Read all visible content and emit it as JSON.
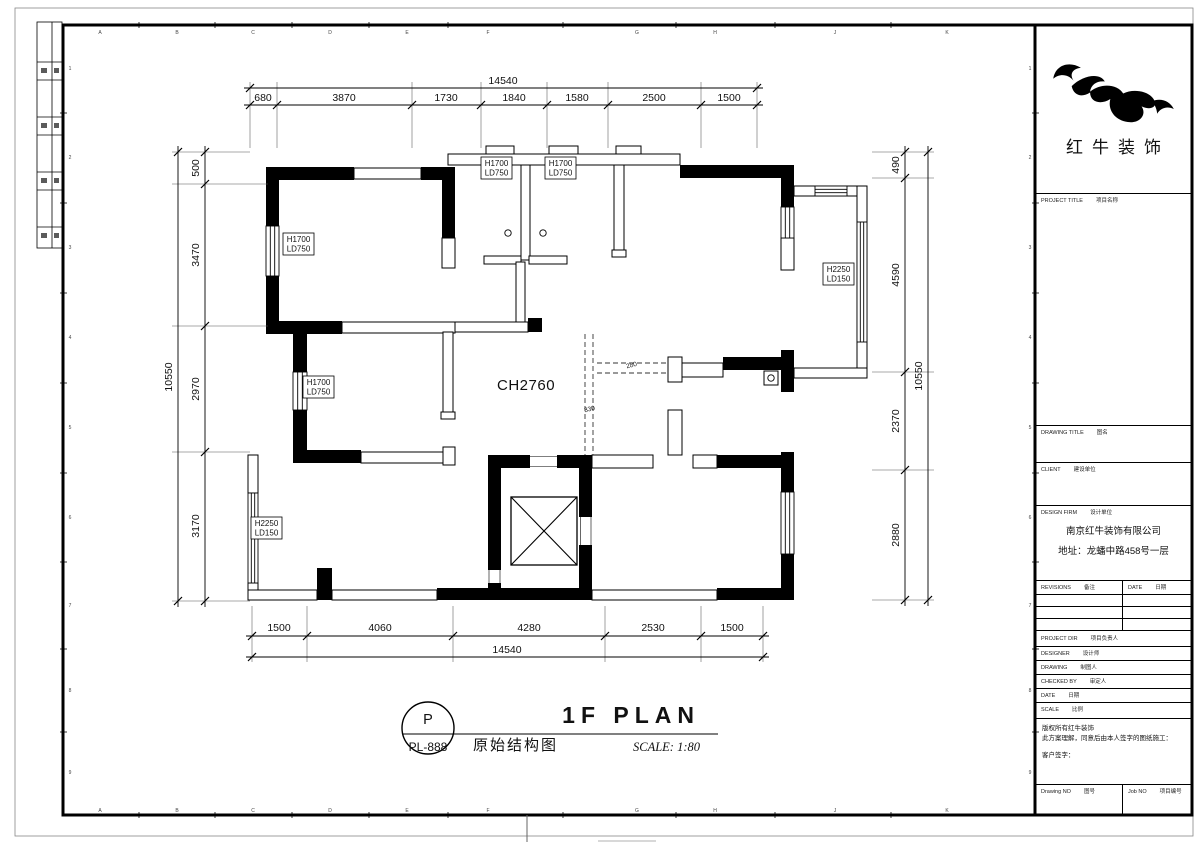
{
  "sheet": {
    "grid_letters": [
      "A",
      "B",
      "C",
      "D",
      "E",
      "F",
      "G",
      "H",
      "J",
      "K"
    ],
    "grid_numbers": [
      "1",
      "2",
      "3",
      "4",
      "5",
      "6",
      "7",
      "8",
      "9"
    ]
  },
  "plan": {
    "ch_label": "CH2760",
    "beam_labels": {
      "b1": "280",
      "b2": "330"
    },
    "window_small": {
      "l1": "H1700",
      "l2": "LD750"
    },
    "window_large": {
      "l1": "H2250",
      "l2": "LD150"
    },
    "dims": {
      "top": {
        "total": "14540",
        "segs": [
          "680",
          "3870",
          "1730",
          "1840",
          "1580",
          "2500",
          "1500"
        ]
      },
      "bottom": {
        "total": "14540",
        "segs": [
          "1500",
          "4060",
          "4280",
          "2530",
          "1500"
        ]
      },
      "left": {
        "total": "10550",
        "segs": [
          "500",
          "3470",
          "2970",
          "3170"
        ]
      },
      "right": {
        "total": "10550",
        "segs": [
          "490",
          "4590",
          "2370",
          "2880"
        ]
      }
    }
  },
  "footer": {
    "bubble_letter": "P",
    "bubble_code": "PL-888",
    "title": "1F PLAN",
    "subtitle": "原始结构图",
    "scale": "SCALE: 1:80"
  },
  "title_block": {
    "brand": "红牛装饰",
    "project_title_en": "PROJECT TITLE",
    "project_title_zh": "项目名称",
    "drawing_title_en": "DRAWING TITLE",
    "drawing_title_zh": "图名",
    "client_en": "CLIENT",
    "client_zh": "建设单位",
    "design_firm_en": "DESIGN FIRM",
    "design_firm_zh": "设计单位",
    "company": "南京红牛装饰有限公司",
    "address": "地址：龙蟠中路458号一层",
    "revisions_en": "REVISIONS",
    "revisions_zh": "备注",
    "date_col_en": "DATE",
    "date_col_zh": "日期",
    "rows": [
      {
        "en": "PROJECT DIR",
        "zh": "项目负责人"
      },
      {
        "en": "DESIGNER",
        "zh": "设计师"
      },
      {
        "en": "DRAWING",
        "zh": "制图人"
      },
      {
        "en": "CHECKED BY",
        "zh": "审定人"
      },
      {
        "en": "DATE",
        "zh": "日期"
      },
      {
        "en": "SCALE",
        "zh": "比例"
      }
    ],
    "copyright_lines": [
      "版权所有红牛装饰",
      "此方案理解，同意后由本人签字的图纸施工：",
      "客户签字："
    ],
    "drawing_no_en": "Drawing NO",
    "drawing_no_zh": "图号",
    "job_no_en": "Job NO",
    "job_no_zh": "项目编号"
  }
}
